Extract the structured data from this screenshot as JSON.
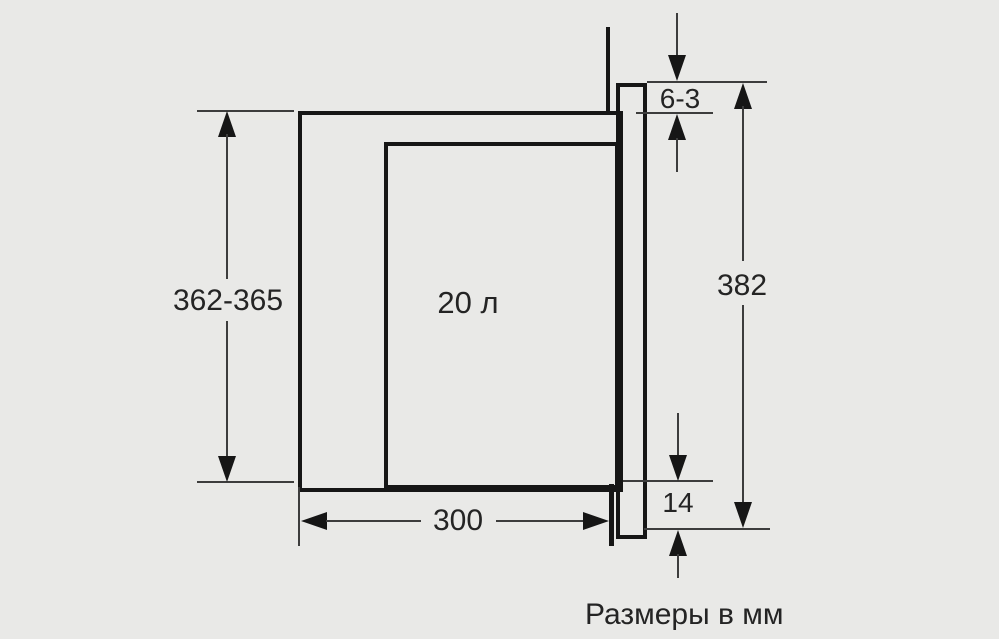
{
  "diagram": {
    "title_caption": "Размеры в мм",
    "labels": {
      "appliance_height_range": "362-365",
      "top_gap": "6-3",
      "niche_total_height": "382",
      "depth": "300",
      "bottom_overhang": "14",
      "cavity_volume": "20 л"
    },
    "colors": {
      "background": "#e9e9e7",
      "object_line": "#161616",
      "dimension_line": "#3d3d3d",
      "text": "#242424"
    }
  }
}
